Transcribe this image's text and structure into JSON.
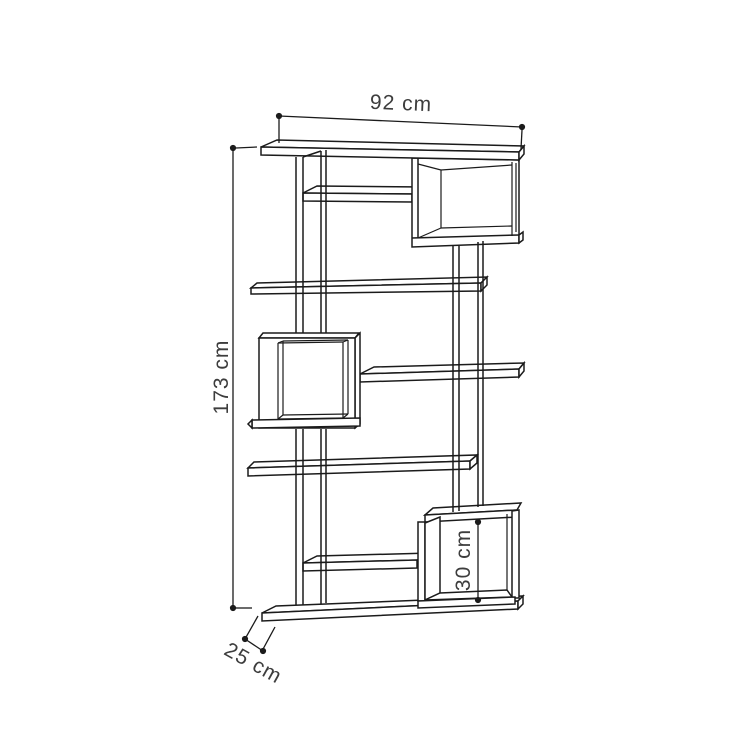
{
  "diagram": {
    "dimensions": {
      "width": "92 cm",
      "height": "173 cm",
      "depth": "25 cm",
      "inner_cube_height": "30 cm"
    },
    "colors": {
      "background": "#ffffff",
      "line": "#1b1b1b",
      "text": "#3d3d3d"
    }
  }
}
